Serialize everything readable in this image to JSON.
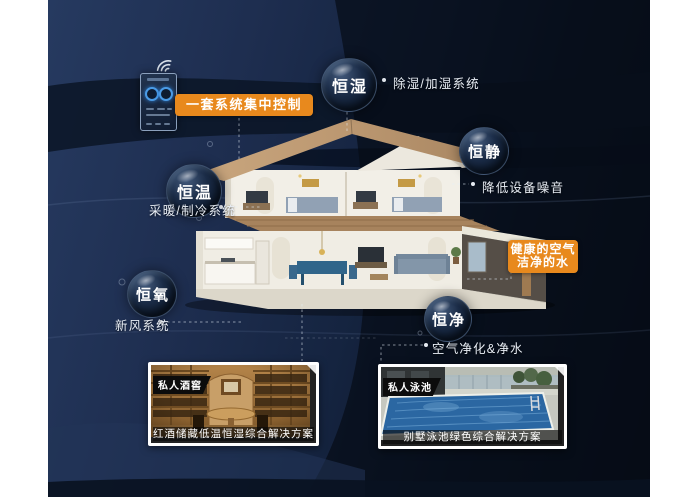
{
  "colors": {
    "accent_orange": "#e8891d",
    "canvas_navy": "#1c2b4a",
    "label_text": "#e9eef5"
  },
  "control_panel": {
    "badge": "一套系统集中控制"
  },
  "health_badge": {
    "line1": "健康的空气",
    "line2": "洁净的水"
  },
  "features": [
    {
      "name": "恒湿",
      "system": "除湿/加湿系统"
    },
    {
      "name": "恒静",
      "system": "降低设备噪音"
    },
    {
      "name": "恒温",
      "system": "采暖/制冷系统"
    },
    {
      "name": "恒氧",
      "system": "新风系统"
    },
    {
      "name": "恒净",
      "system": "空气净化&净水"
    }
  ],
  "cards": [
    {
      "tag": "私人酒窖",
      "caption": "红酒储藏低温恒湿综合解决方案"
    },
    {
      "tag": "私人泳池",
      "caption": "别墅泳池绿色综合解决方案"
    }
  ]
}
